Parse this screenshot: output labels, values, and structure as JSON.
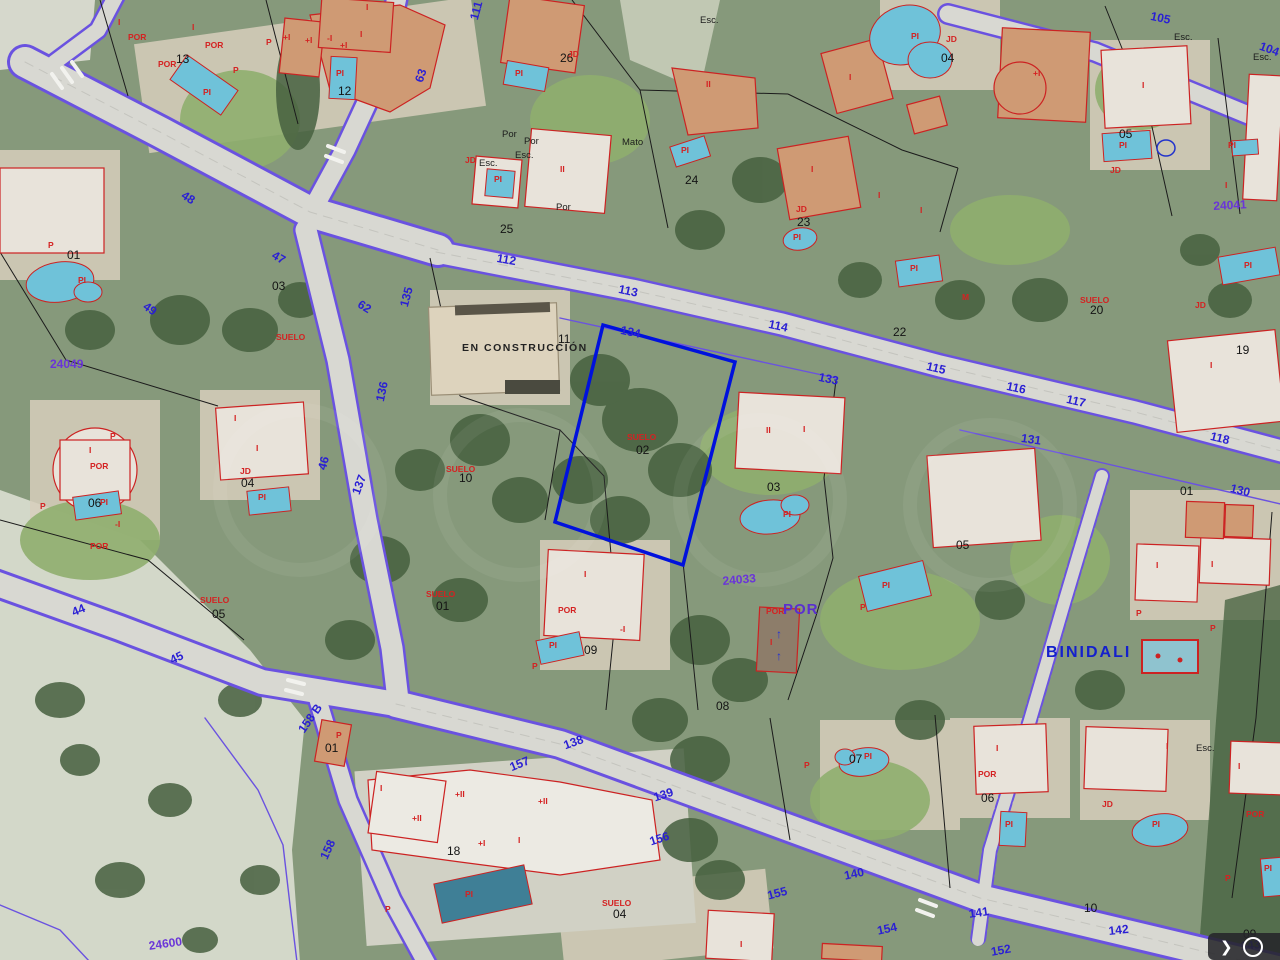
{
  "map": {
    "place_label": "BINIDALI",
    "construction_label": "EN CONSTRUCCIÓN",
    "por_overlay_label": "POR",
    "selected_parcel": {
      "land_label": "SUELO",
      "number": "02"
    },
    "accent_colors": {
      "selected_parcel": "#0011dd",
      "road_edge": "#6a52e0",
      "building_outline": "#cc2222",
      "pool_fill": "#6fc2d9"
    },
    "road_labels": [
      {
        "t": "49",
        "x": 148,
        "y": 300,
        "r": 35
      },
      {
        "t": "62",
        "x": 362,
        "y": 298,
        "r": 32
      },
      {
        "t": "48",
        "x": 186,
        "y": 189,
        "r": 33
      },
      {
        "t": "47",
        "x": 276,
        "y": 249,
        "r": 30
      },
      {
        "t": "63",
        "x": 413,
        "y": 80,
        "r": -72
      },
      {
        "t": "111",
        "x": 468,
        "y": 18,
        "r": -75
      },
      {
        "t": "105",
        "x": 1152,
        "y": 10,
        "r": 12
      },
      {
        "t": "104",
        "x": 1262,
        "y": 40,
        "r": 20
      },
      {
        "t": "112",
        "x": 498,
        "y": 252,
        "r": 10
      },
      {
        "t": "113",
        "x": 620,
        "y": 283,
        "r": 12
      },
      {
        "t": "134",
        "x": 622,
        "y": 324,
        "r": 12
      },
      {
        "t": "114",
        "x": 770,
        "y": 318,
        "r": 12
      },
      {
        "t": "133",
        "x": 820,
        "y": 371,
        "r": 12
      },
      {
        "t": "115",
        "x": 928,
        "y": 360,
        "r": 13
      },
      {
        "t": "116",
        "x": 1008,
        "y": 380,
        "r": 12
      },
      {
        "t": "117",
        "x": 1068,
        "y": 393,
        "r": 13
      },
      {
        "t": "131",
        "x": 1022,
        "y": 432,
        "r": 8
      },
      {
        "t": "118",
        "x": 1212,
        "y": 430,
        "r": 14
      },
      {
        "t": "130",
        "x": 1232,
        "y": 482,
        "r": 14
      },
      {
        "t": "135",
        "x": 398,
        "y": 305,
        "r": -75
      },
      {
        "t": "136",
        "x": 374,
        "y": 400,
        "r": -78
      },
      {
        "t": "46",
        "x": 316,
        "y": 468,
        "r": -75
      },
      {
        "t": "137",
        "x": 350,
        "y": 492,
        "r": -70
      },
      {
        "t": "44",
        "x": 70,
        "y": 607,
        "r": -22
      },
      {
        "t": "45",
        "x": 168,
        "y": 655,
        "r": -25
      },
      {
        "t": "138",
        "x": 562,
        "y": 740,
        "r": -20
      },
      {
        "t": "157",
        "x": 508,
        "y": 762,
        "r": -22
      },
      {
        "t": "139",
        "x": 652,
        "y": 792,
        "r": -18
      },
      {
        "t": "156",
        "x": 648,
        "y": 836,
        "r": -18
      },
      {
        "t": "158 B",
        "x": 296,
        "y": 728,
        "r": -55
      },
      {
        "t": "158",
        "x": 318,
        "y": 856,
        "r": -65
      },
      {
        "t": "140",
        "x": 843,
        "y": 870,
        "r": -12
      },
      {
        "t": "155",
        "x": 766,
        "y": 890,
        "r": -15
      },
      {
        "t": "154",
        "x": 876,
        "y": 925,
        "r": -12
      },
      {
        "t": "141",
        "x": 968,
        "y": 908,
        "r": -8
      },
      {
        "t": "142",
        "x": 1108,
        "y": 925,
        "r": -6
      },
      {
        "t": "143",
        "x": 1240,
        "y": 940,
        "r": -5
      },
      {
        "t": "152",
        "x": 990,
        "y": 946,
        "r": -10
      }
    ],
    "ref_numbers": [
      {
        "t": "24049",
        "x": 50,
        "y": 358,
        "r": 0
      },
      {
        "t": "24041",
        "x": 1213,
        "y": 200,
        "r": -3
      },
      {
        "t": "24033",
        "x": 722,
        "y": 575,
        "r": -5
      },
      {
        "t": "24600",
        "x": 148,
        "y": 940,
        "r": -8
      }
    ],
    "parcel_numbers": [
      {
        "t": "13",
        "x": 176,
        "y": 53
      },
      {
        "t": "12",
        "x": 338,
        "y": 85
      },
      {
        "t": "26",
        "x": 560,
        "y": 52
      },
      {
        "t": "25",
        "x": 500,
        "y": 223
      },
      {
        "t": "24",
        "x": 685,
        "y": 174
      },
      {
        "t": "23",
        "x": 797,
        "y": 216
      },
      {
        "t": "04",
        "x": 941,
        "y": 52
      },
      {
        "t": "05",
        "x": 1119,
        "y": 128
      },
      {
        "t": "01",
        "x": 67,
        "y": 249
      },
      {
        "t": "03",
        "x": 272,
        "y": 280
      },
      {
        "t": "22",
        "x": 893,
        "y": 326
      },
      {
        "t": "20",
        "x": 1090,
        "y": 304
      },
      {
        "t": "19",
        "x": 1236,
        "y": 344
      },
      {
        "t": "11",
        "x": 558,
        "y": 333
      },
      {
        "t": "10",
        "x": 459,
        "y": 472
      },
      {
        "t": "02",
        "x": 636,
        "y": 444
      },
      {
        "t": "03",
        "x": 767,
        "y": 481
      },
      {
        "t": "05",
        "x": 956,
        "y": 539
      },
      {
        "t": "04",
        "x": 241,
        "y": 477
      },
      {
        "t": "06",
        "x": 88,
        "y": 497
      },
      {
        "t": "05",
        "x": 212,
        "y": 608
      },
      {
        "t": "01",
        "x": 436,
        "y": 600
      },
      {
        "t": "09",
        "x": 584,
        "y": 644
      },
      {
        "t": "08",
        "x": 716,
        "y": 700
      },
      {
        "t": "07",
        "x": 849,
        "y": 753
      },
      {
        "t": "18",
        "x": 447,
        "y": 845
      },
      {
        "t": "01",
        "x": 325,
        "y": 742
      },
      {
        "t": "04",
        "x": 613,
        "y": 908
      },
      {
        "t": "06",
        "x": 981,
        "y": 792
      },
      {
        "t": "10",
        "x": 1084,
        "y": 902
      },
      {
        "t": "01",
        "x": 1180,
        "y": 485
      },
      {
        "t": "09",
        "x": 1243,
        "y": 928
      }
    ],
    "black_labels": [
      {
        "t": "Esc.",
        "x": 700,
        "y": 16
      },
      {
        "t": "Por",
        "x": 502,
        "y": 130
      },
      {
        "t": "Por",
        "x": 524,
        "y": 137
      },
      {
        "t": "Esc.",
        "x": 515,
        "y": 151
      },
      {
        "t": "Esc.",
        "x": 479,
        "y": 159
      },
      {
        "t": "Por",
        "x": 556,
        "y": 203
      },
      {
        "t": "Mato",
        "x": 622,
        "y": 138
      },
      {
        "t": "Esc.",
        "x": 1174,
        "y": 33
      },
      {
        "t": "Esc.",
        "x": 1253,
        "y": 53
      },
      {
        "t": "Esc.",
        "x": 1196,
        "y": 744
      }
    ],
    "building_labels": [
      {
        "t": "I",
        "x": 118,
        "y": 18
      },
      {
        "t": "POR",
        "x": 128,
        "y": 33
      },
      {
        "t": "I",
        "x": 192,
        "y": 23
      },
      {
        "t": "POR",
        "x": 205,
        "y": 41
      },
      {
        "t": "POR",
        "x": 158,
        "y": 60
      },
      {
        "t": "P",
        "x": 233,
        "y": 66
      },
      {
        "t": "PI",
        "x": 203,
        "y": 88
      },
      {
        "t": "P",
        "x": 266,
        "y": 38
      },
      {
        "t": "+I",
        "x": 283,
        "y": 33
      },
      {
        "t": "+I",
        "x": 305,
        "y": 36
      },
      {
        "t": "I",
        "x": 366,
        "y": 3
      },
      {
        "t": "I",
        "x": 360,
        "y": 30
      },
      {
        "t": "-I",
        "x": 327,
        "y": 34
      },
      {
        "t": "+I",
        "x": 340,
        "y": 41
      },
      {
        "t": "PI",
        "x": 336,
        "y": 69
      },
      {
        "t": "JD",
        "x": 568,
        "y": 50
      },
      {
        "t": "PI",
        "x": 515,
        "y": 69
      },
      {
        "t": "JD",
        "x": 465,
        "y": 156
      },
      {
        "t": "PI",
        "x": 494,
        "y": 175
      },
      {
        "t": "II",
        "x": 560,
        "y": 165
      },
      {
        "t": "II",
        "x": 706,
        "y": 80
      },
      {
        "t": "PI",
        "x": 681,
        "y": 146
      },
      {
        "t": "I",
        "x": 849,
        "y": 73
      },
      {
        "t": "JD",
        "x": 946,
        "y": 35
      },
      {
        "t": "PI",
        "x": 911,
        "y": 32
      },
      {
        "t": "I",
        "x": 811,
        "y": 165
      },
      {
        "t": "JD",
        "x": 796,
        "y": 205
      },
      {
        "t": "PI",
        "x": 793,
        "y": 233
      },
      {
        "t": "I",
        "x": 878,
        "y": 191
      },
      {
        "t": "I",
        "x": 920,
        "y": 206
      },
      {
        "t": "+I",
        "x": 1033,
        "y": 69
      },
      {
        "t": "I",
        "x": 1142,
        "y": 81
      },
      {
        "t": "PI",
        "x": 1119,
        "y": 141
      },
      {
        "t": "JD",
        "x": 1110,
        "y": 166
      },
      {
        "t": "PI",
        "x": 1228,
        "y": 141
      },
      {
        "t": "I",
        "x": 1225,
        "y": 181
      },
      {
        "t": "M",
        "x": 962,
        "y": 293
      },
      {
        "t": "SUELO",
        "x": 1080,
        "y": 296
      },
      {
        "t": "JD",
        "x": 1195,
        "y": 301
      },
      {
        "t": "PI",
        "x": 1244,
        "y": 261
      },
      {
        "t": "I",
        "x": 1210,
        "y": 361
      },
      {
        "t": "P",
        "x": 48,
        "y": 241
      },
      {
        "t": "PI",
        "x": 78,
        "y": 276
      },
      {
        "t": "SUELO",
        "x": 276,
        "y": 333
      },
      {
        "t": "SUELO",
        "x": 446,
        "y": 465
      },
      {
        "t": "SUELO",
        "x": 627,
        "y": 433
      },
      {
        "t": "SUELO",
        "x": 200,
        "y": 596
      },
      {
        "t": "SUELO",
        "x": 426,
        "y": 590
      },
      {
        "t": "SUELO",
        "x": 602,
        "y": 899
      },
      {
        "t": "I",
        "x": 234,
        "y": 414
      },
      {
        "t": "I",
        "x": 256,
        "y": 444
      },
      {
        "t": "JD",
        "x": 240,
        "y": 467
      },
      {
        "t": "PI",
        "x": 258,
        "y": 493
      },
      {
        "t": "P",
        "x": 110,
        "y": 432
      },
      {
        "t": "I",
        "x": 89,
        "y": 446
      },
      {
        "t": "POR",
        "x": 90,
        "y": 462
      },
      {
        "t": "P",
        "x": 40,
        "y": 502
      },
      {
        "t": "PI",
        "x": 100,
        "y": 498
      },
      {
        "t": "-I",
        "x": 115,
        "y": 520
      },
      {
        "t": "POR",
        "x": 90,
        "y": 542
      },
      {
        "t": "PI",
        "x": 910,
        "y": 264
      },
      {
        "t": "II",
        "x": 766,
        "y": 426
      },
      {
        "t": "I",
        "x": 803,
        "y": 425
      },
      {
        "t": "PI",
        "x": 783,
        "y": 510
      },
      {
        "t": "PI",
        "x": 882,
        "y": 581
      },
      {
        "t": "P",
        "x": 860,
        "y": 603
      },
      {
        "t": "I",
        "x": 584,
        "y": 570
      },
      {
        "t": "POR",
        "x": 558,
        "y": 606
      },
      {
        "t": "PI",
        "x": 549,
        "y": 641
      },
      {
        "t": "-I",
        "x": 620,
        "y": 625
      },
      {
        "t": "P",
        "x": 532,
        "y": 662
      },
      {
        "t": "POR",
        "x": 766,
        "y": 607
      },
      {
        "t": "I",
        "x": 770,
        "y": 638
      },
      {
        "t": "PI",
        "x": 864,
        "y": 752
      },
      {
        "t": "P",
        "x": 804,
        "y": 761
      },
      {
        "t": "P",
        "x": 336,
        "y": 731
      },
      {
        "t": "I",
        "x": 380,
        "y": 784
      },
      {
        "t": "+II",
        "x": 412,
        "y": 814
      },
      {
        "t": "+II",
        "x": 455,
        "y": 790
      },
      {
        "t": "+II",
        "x": 538,
        "y": 797
      },
      {
        "t": "+I",
        "x": 478,
        "y": 839
      },
      {
        "t": "I",
        "x": 518,
        "y": 836
      },
      {
        "t": "PI",
        "x": 465,
        "y": 890
      },
      {
        "t": "P",
        "x": 385,
        "y": 905
      },
      {
        "t": "I",
        "x": 740,
        "y": 940
      },
      {
        "t": "I",
        "x": 996,
        "y": 744
      },
      {
        "t": "POR",
        "x": 978,
        "y": 770
      },
      {
        "t": "PI",
        "x": 1005,
        "y": 820
      },
      {
        "t": "JD",
        "x": 1102,
        "y": 800
      },
      {
        "t": "PI",
        "x": 1152,
        "y": 820
      },
      {
        "t": "I",
        "x": 1166,
        "y": 742
      },
      {
        "t": "I",
        "x": 1238,
        "y": 762
      },
      {
        "t": "POR",
        "x": 1246,
        "y": 810
      },
      {
        "t": "PI",
        "x": 1264,
        "y": 864
      },
      {
        "t": "P",
        "x": 1225,
        "y": 874
      },
      {
        "t": "I",
        "x": 1156,
        "y": 561
      },
      {
        "t": "I",
        "x": 1211,
        "y": 560
      },
      {
        "t": "P",
        "x": 1136,
        "y": 609
      },
      {
        "t": "P",
        "x": 1210,
        "y": 624
      }
    ],
    "blue_symbols": [
      {
        "t": "↑",
        "x": 776,
        "y": 628
      },
      {
        "t": "↑",
        "x": 776,
        "y": 650
      }
    ]
  },
  "toolbar": {
    "chevron": "❯"
  }
}
